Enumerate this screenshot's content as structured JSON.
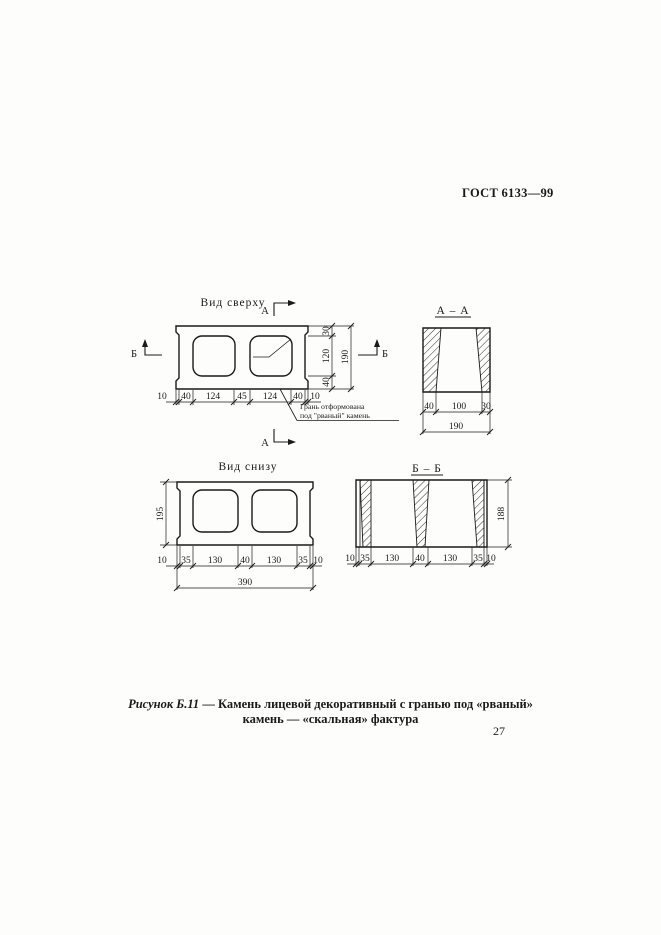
{
  "page": {
    "header": "ГОСТ 6133—99",
    "number": "27"
  },
  "figure": {
    "caption_label": "Рисунок Б.11",
    "caption_line1_rest": "— Камень лицевой декоративный с гранью под «рваный»",
    "caption_line2": "камень — «скальная» фактура"
  },
  "top_view": {
    "title": "Вид сверху",
    "section_letter_a": "А",
    "section_letter_b": "Б",
    "note_line1": "Грань отформована",
    "note_line2": "под \"рваный\" камень",
    "dims_bottom": [
      "10",
      "40",
      "124",
      "45",
      "124",
      "40",
      "10"
    ],
    "dims_right": [
      "30",
      "120",
      "40"
    ],
    "dim_overall_right": "190"
  },
  "section_aa": {
    "title": "А – А",
    "dims_bottom": [
      "40",
      "100",
      "30"
    ],
    "dim_overall": "190"
  },
  "bottom_view": {
    "title": "Вид снизу",
    "dim_left": "195",
    "dims_bottom": [
      "10",
      "35",
      "130",
      "40",
      "130",
      "35",
      "10"
    ],
    "dim_overall": "390"
  },
  "section_bb": {
    "title": "Б – Б",
    "dim_right": "188",
    "dims_bottom": [
      "10",
      "35",
      "130",
      "40",
      "130",
      "35",
      "10"
    ]
  }
}
